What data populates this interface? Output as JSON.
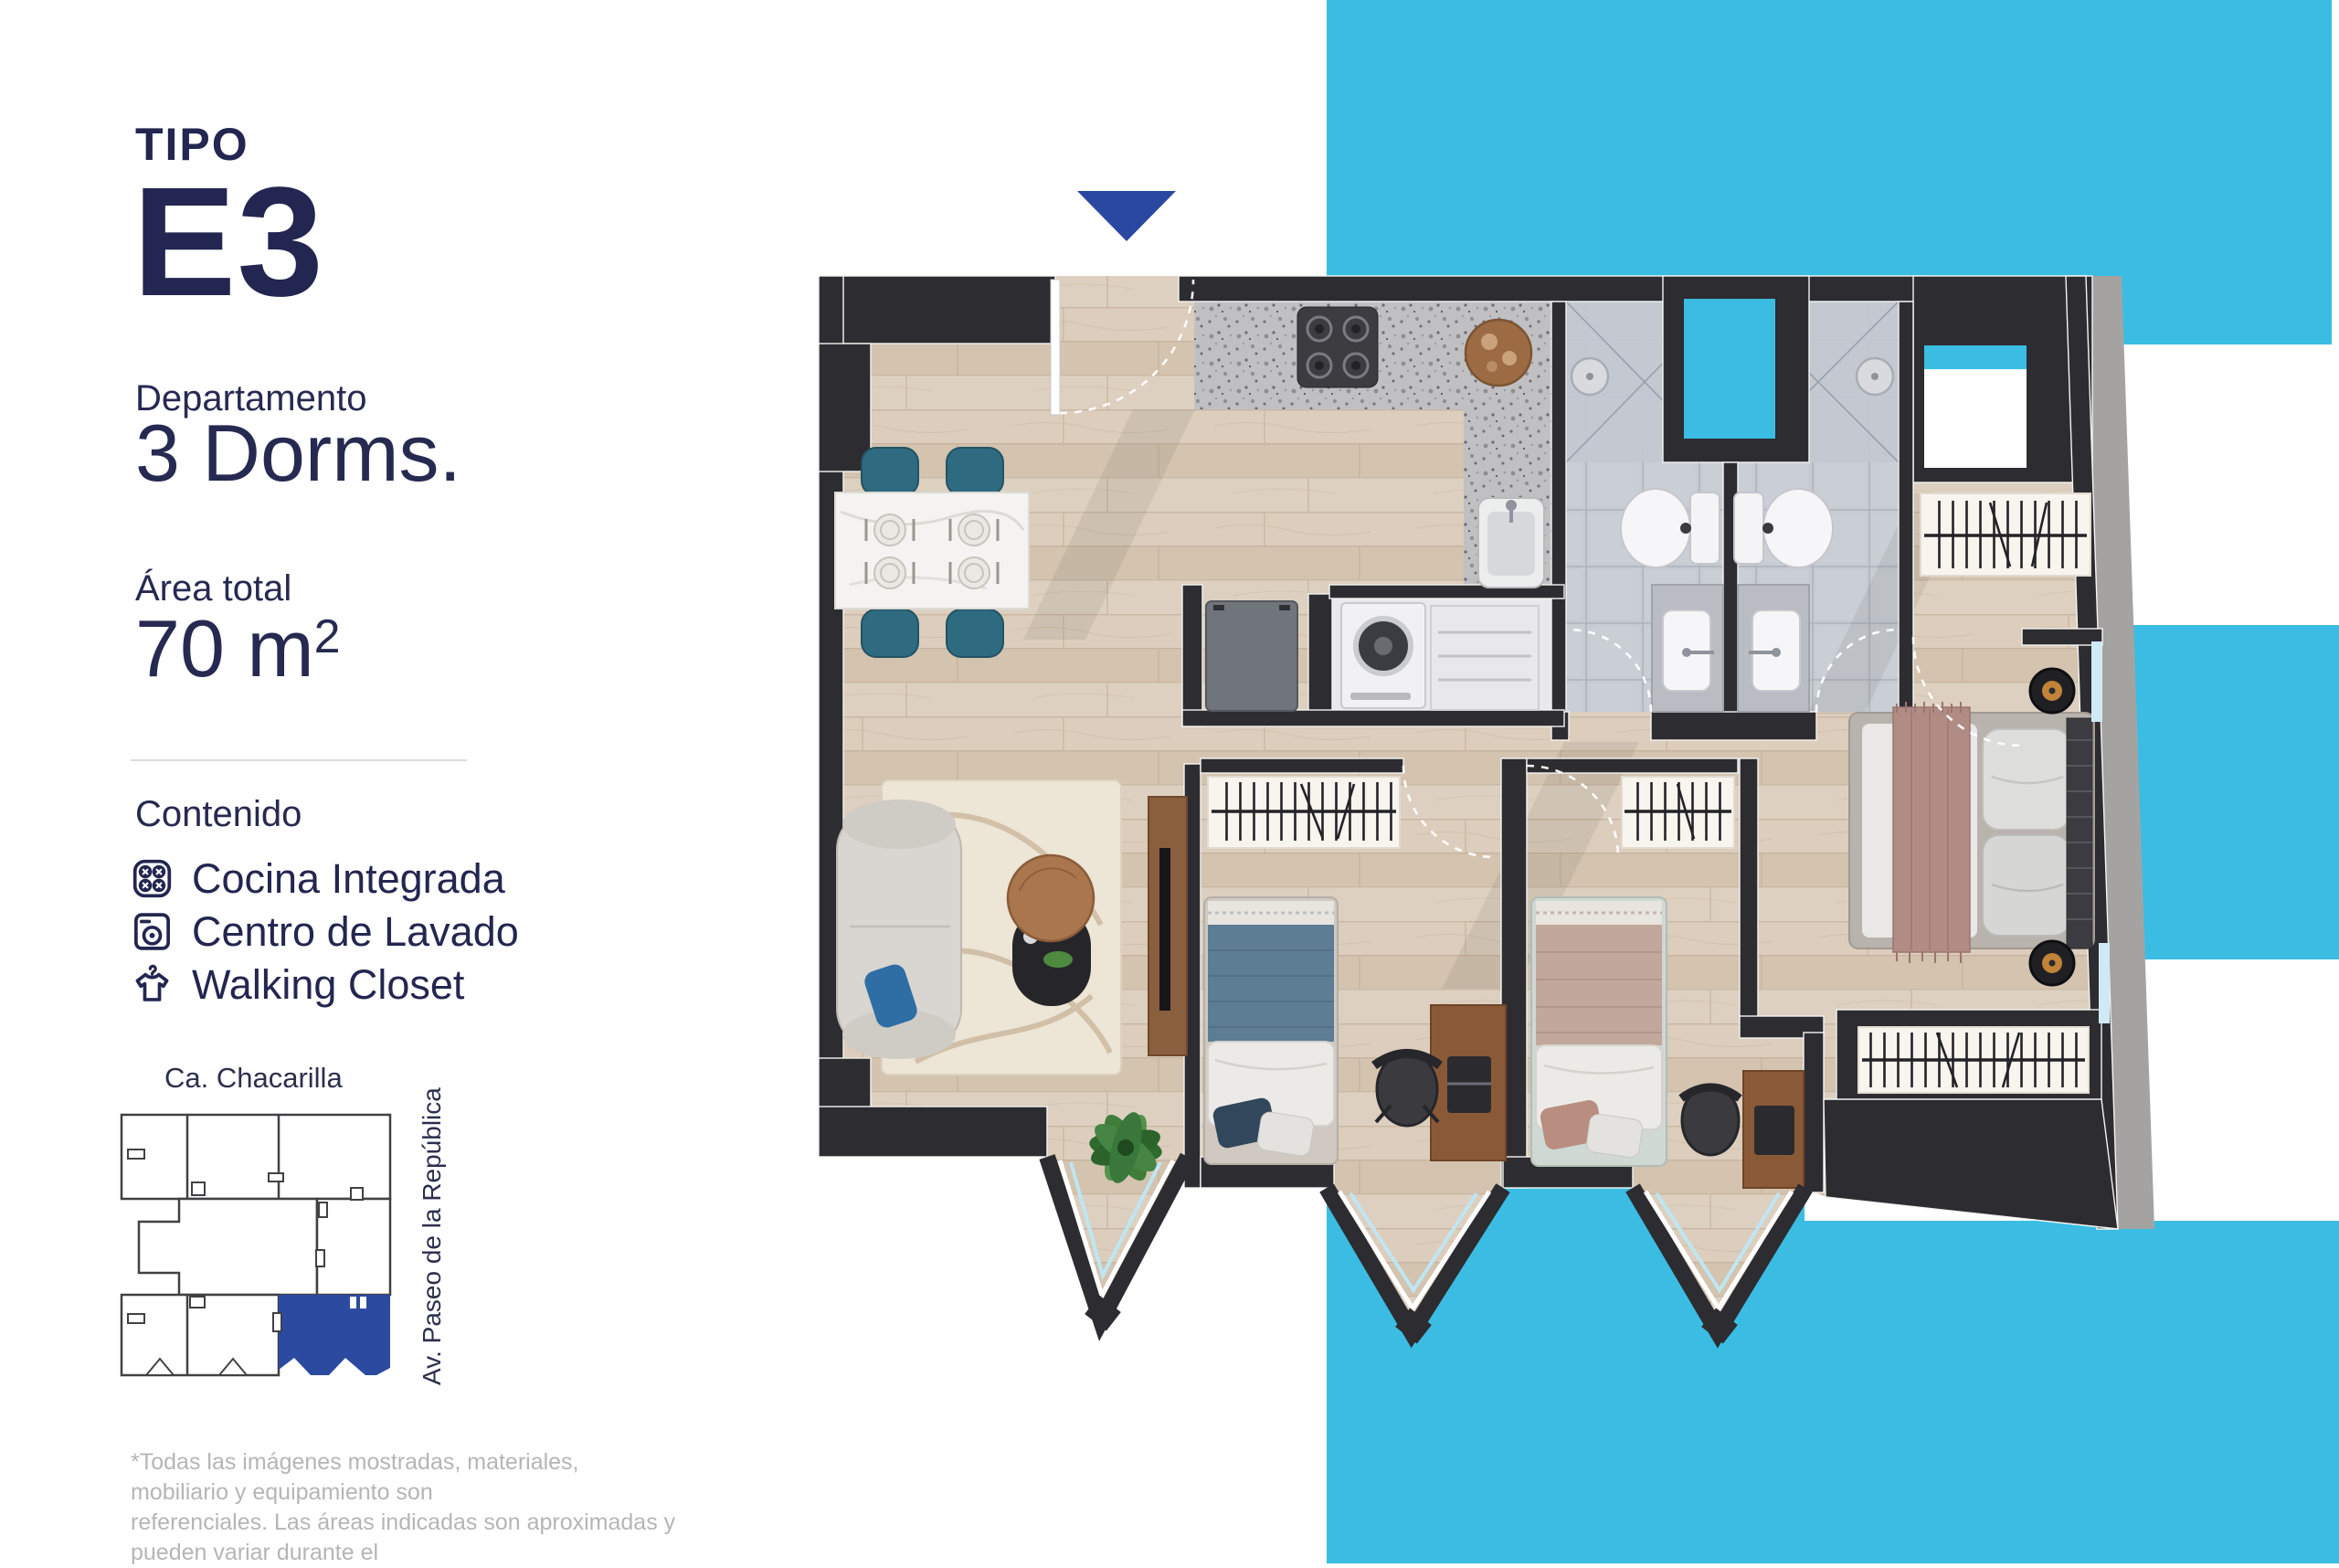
{
  "accent": {
    "cyan": "#3BBDE3",
    "royal_blue": "#2B48A1",
    "navy": "#232650",
    "map_highlight": "#2B4AA0",
    "wall": "#2D2C31"
  },
  "panel": {
    "type_label": "TIPO",
    "type_code": "E3",
    "unit_type": "Departamento",
    "bedrooms": "3 Dorms.",
    "area_label": "Área total",
    "area_value": "70 m",
    "area_exponent": "2",
    "contents_title": "Contenido",
    "contents": [
      {
        "icon": "cooktop-icon",
        "label": "Cocina Integrada"
      },
      {
        "icon": "washer-icon",
        "label": "Centro de Lavado"
      },
      {
        "icon": "tshirt-hanger-icon",
        "label": "Walking Closet"
      }
    ],
    "disclaimer_line1": "*Todas las imágenes mostradas, materiales, mobiliario y equipamiento son",
    "disclaimer_line2": "referenciales. Las áreas indicadas son aproximadas y pueden variar durante el"
  },
  "map": {
    "street_top": "Ca. Chacarilla",
    "street_right": "Av. Paseo de la República"
  }
}
